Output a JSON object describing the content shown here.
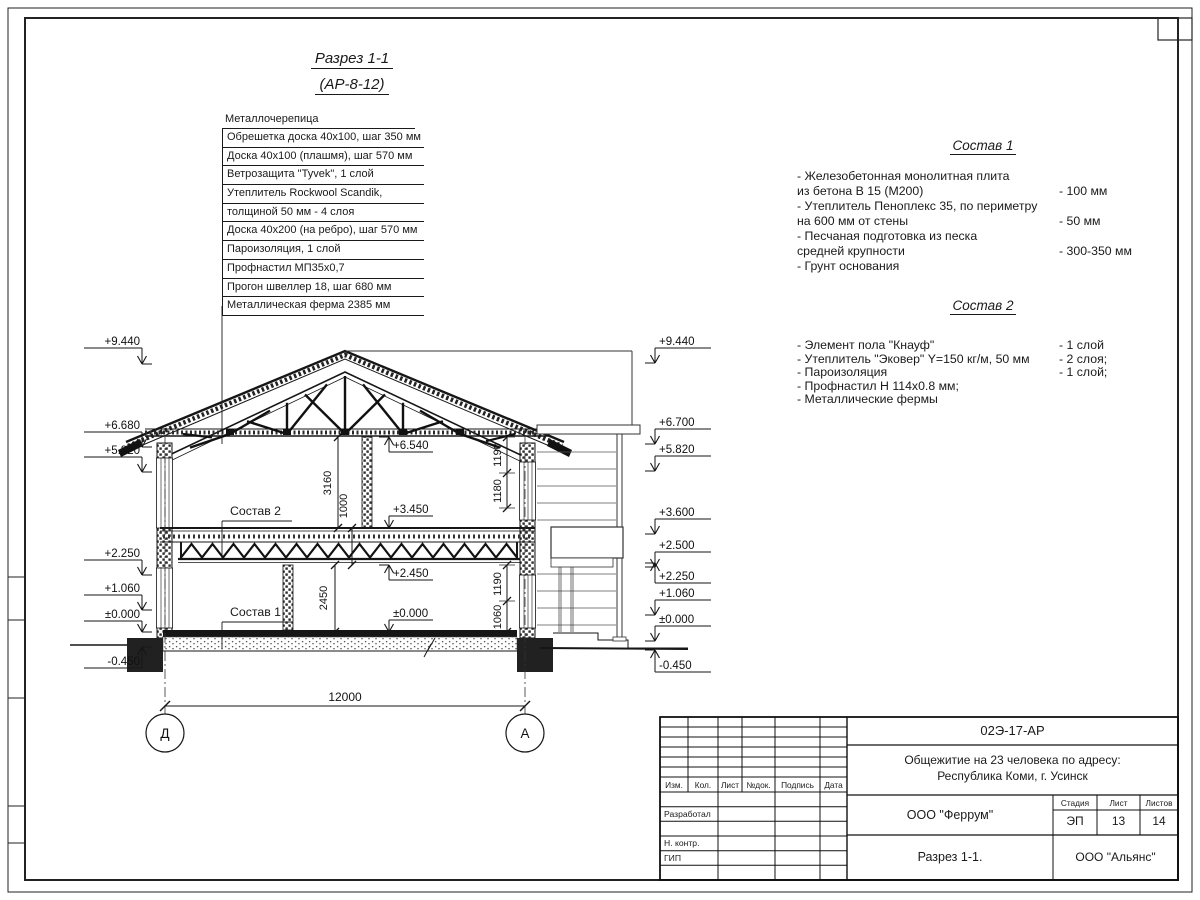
{
  "drawing": {
    "title_line1": "Разрез 1-1",
    "title_line2": "(АР-8-12)",
    "roof_layers": {
      "header": "Металлочерепица",
      "rows": [
        "Обрешетка доска 40х100, шаг 350 мм",
        "Доска 40х100 (плашмя), шаг 570 мм",
        "Ветрозащита \"Tyvek\", 1 слой",
        "Утеплитель Rockwool Scandik,",
        "толщиной 50 мм - 4 слоя",
        "Доска 40х200 (на ребро), шаг 570 мм",
        "Пароизоляция, 1 слой",
        "Профнастил МП35х0,7",
        "Прогон швеллер 18, шаг 680 мм",
        "Металлическая ферма 2385 мм"
      ]
    },
    "sostav1": {
      "title": "Состав 1",
      "items": [
        {
          "t": "- Железобетонная монолитная плита\n из бетона В 15 (М200)",
          "v": "- 100 мм"
        },
        {
          "t": "- Утеплитель Пеноплекс 35, по периметру\n на 600 мм от стены",
          "v": "- 50 мм"
        },
        {
          "t": "- Песчаная подготовка из песка\n средней крупности",
          "v": "- 300-350 мм"
        },
        {
          "t": "- Грунт основания",
          "v": ""
        }
      ]
    },
    "sostav2": {
      "title": "Состав 2",
      "items": [
        {
          "t": "- Элемент пола \"Кнауф\"",
          "v": "- 1 слой"
        },
        {
          "t": "- Утеплитель \"Эковер\" Y=150 кг/м, 50 мм",
          "v": "- 2 слоя;"
        },
        {
          "t": "- Пароизоляция",
          "v": "- 1 слой;"
        },
        {
          "t": "- Профнастил Н 114х0.8 мм;",
          "v": ""
        },
        {
          "t": "- Металлические фермы",
          "v": ""
        }
      ]
    },
    "section_labels": [
      "Состав 2",
      "Состав 1"
    ],
    "levels": {
      "left": [
        "+9.440",
        "+6.680",
        "+5.820",
        "+2.250",
        "+1.060",
        "±0.000",
        "-0.450"
      ],
      "right": [
        "+9.440",
        "+6.700",
        "+5.820",
        "+3.600",
        "+2.500",
        "+2.250",
        "+1.060",
        "±0.000",
        "-0.450"
      ],
      "internal": [
        "+6.540",
        "+3.450",
        "+2.450",
        "±0.000"
      ]
    },
    "dims": {
      "span": "12000",
      "left_chain": [
        "3160",
        "1000",
        "2450"
      ],
      "right_chain": [
        "1190",
        "1180",
        "1190",
        "1060"
      ]
    },
    "axes": [
      "Д",
      "А"
    ]
  },
  "title_block": {
    "doc_number": "02Э-17-АР",
    "project": "Общежитие на 23 человека по адресу:\nРеспублика Коми, г. Усинск",
    "columns": [
      "Изм.",
      "Кол.",
      "Лист",
      "№док.",
      "Подпись",
      "Дата"
    ],
    "roles": [
      "Разработал",
      "Н. контр.",
      "ГИП"
    ],
    "company": "ООО \"Феррум\"",
    "stage_label": "Стадия",
    "sheet_label": "Лист",
    "sheets_label": "Листов",
    "stage": "ЭП",
    "sheet": "13",
    "sheets": "14",
    "sheet_title": "Разрез 1-1.",
    "contractor": "ООО \"Альянс\""
  }
}
